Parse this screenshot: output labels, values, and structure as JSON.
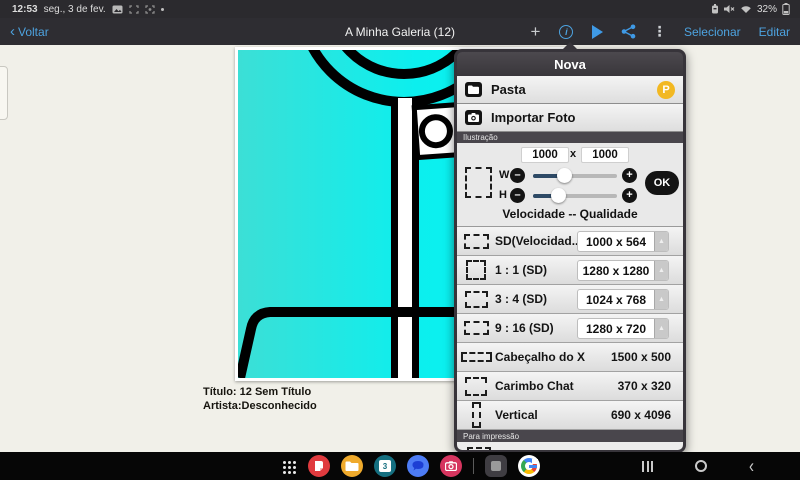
{
  "status_bar": {
    "time": "12:53",
    "date": "seg., 3 de fev.",
    "battery_percent": "32%",
    "icons": [
      "screenshot-icon",
      "capture-frame-icon",
      "smart-capture-icon",
      "more-dot-icon",
      "battery-saver-icon",
      "mute-icon",
      "wifi-icon",
      "battery-icon"
    ]
  },
  "toolbar": {
    "back_label": "Voltar",
    "back_chevron": "‹",
    "title": "A Minha Galeria (12)",
    "plus_glyph": "+",
    "info_glyph": "i",
    "more_glyph": "⋮",
    "select_label": "Selecionar",
    "edit_label": "Editar"
  },
  "artwork": {
    "caption_title": "Título: 12 Sem Título",
    "caption_artist": "Artista:Desconhecido"
  },
  "dialog": {
    "title": "Nova",
    "menu": {
      "folder_label": "Pasta",
      "folder_badge": "P",
      "import_label": "Importar Foto"
    },
    "section_illustration": "Ilustração",
    "custom": {
      "width_value": "1000",
      "x_separator": "x",
      "height_value": "1000",
      "w_label": "W",
      "h_label": "H",
      "minus_glyph": "–",
      "plus_glyph": "+",
      "ok_label": "OK",
      "hint": "Velocidade -- Qualidade"
    },
    "presets": [
      {
        "label": "SD(Velocidad...",
        "value": "1000 x 564"
      },
      {
        "label": "1 : 1 (SD)",
        "value": "1280 x 1280"
      },
      {
        "label": "3 : 4 (SD)",
        "value": "1024 x 768"
      },
      {
        "label": "9 : 16 (SD)",
        "value": "1280 x 720"
      },
      {
        "label": "Cabeçalho do X",
        "value": "1500 x 500"
      },
      {
        "label": "Carimbo Chat",
        "value": "370 x 320"
      },
      {
        "label": "Vertical",
        "value": "690 x 4096"
      }
    ],
    "spinner_glyph": "▲",
    "section_print": "Para impressão"
  },
  "taskbar": {
    "icons": [
      "apps-grid-icon",
      "notes-app-icon",
      "my-files-app-icon",
      "calendar-app-icon",
      "messages-app-icon",
      "camera-app-icon",
      "current-app-icon",
      "chrome-app-icon"
    ],
    "calendar_day": "3",
    "nav": [
      "recents-key",
      "home-key",
      "back-key"
    ],
    "nav_back_glyph": "‹"
  },
  "colors": {
    "accent_blue": "#4da3e0",
    "canvas_cyan": "#06f0f0",
    "badge_yellow": "#f2b822",
    "slider_fill": "#2e4a66",
    "dialog_frame": "#37343a"
  }
}
